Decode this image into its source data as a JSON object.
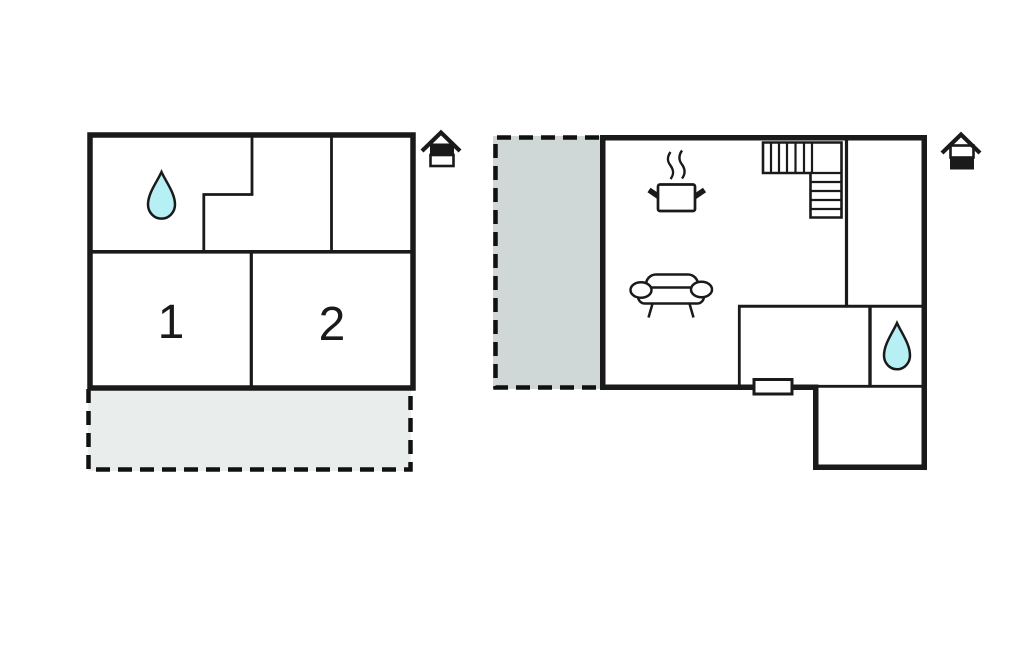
{
  "page": {
    "background": "#ffffff"
  },
  "colors": {
    "wall": "#1a1a1a",
    "drop_fill": "#b6f0f4",
    "terrace_upper_fill": "#e9edec",
    "terrace_ground_fill": "#cfd8d7"
  },
  "upper_floor": {
    "rooms": [
      {
        "label": "1"
      },
      {
        "label": "2"
      }
    ],
    "icons": {
      "bathroom": "water-drop-icon",
      "floor_indicator": "house-upper-half-filled-icon",
      "terrace": "dashed-terrace-area"
    }
  },
  "ground_floor": {
    "icons": {
      "bathroom": "water-drop-icon",
      "kitchen": "steaming-pot-icon",
      "living": "sofa-icon",
      "stairs": "staircase-icon",
      "window": "window-marker",
      "floor_indicator": "house-lower-half-filled-icon",
      "terrace": "dashed-terrace-area"
    }
  }
}
